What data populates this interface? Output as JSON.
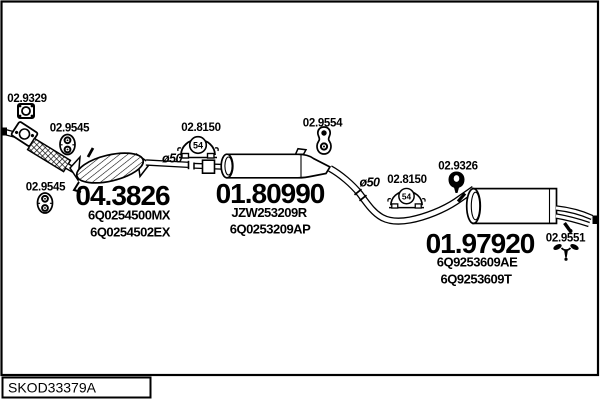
{
  "footer": {
    "code": "SKOD33379A"
  },
  "colors": {
    "line": "#000000",
    "background": "#ffffff"
  },
  "assemblies": {
    "catalyst": {
      "part_number": "04.3826",
      "oe": [
        "6Q0254500MX",
        "6Q0254502EX"
      ]
    },
    "mid_silencer": {
      "part_number": "01.80990",
      "oe": [
        "JZW253209R",
        "6Q0253209AP"
      ]
    },
    "rear_silencer": {
      "part_number": "01.97920",
      "oe": [
        "6Q9253609AE",
        "6Q9253609T"
      ]
    }
  },
  "fittings": {
    "gasket": "02.9329",
    "hanger_front_1": "02.9545",
    "hanger_front_2": "02.9545",
    "clamp_1": {
      "label": "02.8150",
      "size": "54"
    },
    "clamp_2": {
      "label": "02.8150",
      "size": "54"
    },
    "hanger_mid": "02.9554",
    "grommet_rear": "02.9326",
    "bracket_rear": "02.9551"
  },
  "annotations": {
    "pipe_diameter_1": "ø50",
    "pipe_diameter_2": "ø50"
  }
}
